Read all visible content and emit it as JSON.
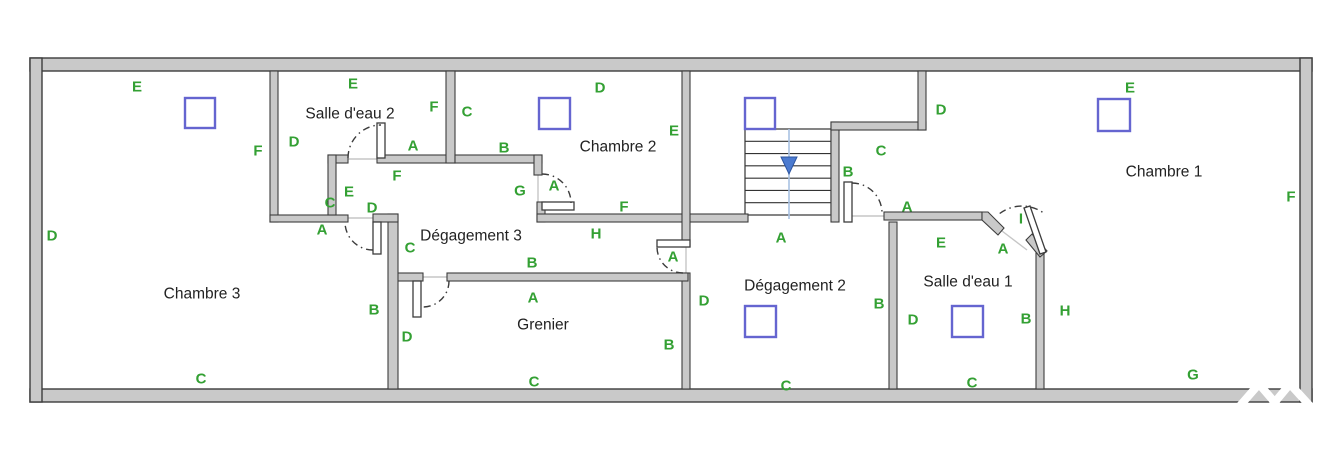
{
  "canvas": {
    "width": 1328,
    "height": 472,
    "background": "#ffffff"
  },
  "colors": {
    "wall_fill": "#c9c9c9",
    "wall_stroke": "#3d3d3d",
    "label_green": "#33a033",
    "room_text": "#222222",
    "skylight_stroke": "#6565d0",
    "stair_line": "#333333",
    "stair_guide": "#a9c2e2",
    "stair_arrow": "#4c7bd0",
    "door_arc": "#3c3c3c",
    "threshold": "#c6c6c6",
    "watermark": "#ffffff"
  },
  "rooms": [
    {
      "name": "Chambre 3",
      "x": 202,
      "y": 294
    },
    {
      "name": "Salle d'eau 2",
      "x": 350,
      "y": 114
    },
    {
      "name": "Chambre 2",
      "x": 618,
      "y": 147
    },
    {
      "name": "Chambre 1",
      "x": 1164,
      "y": 172
    },
    {
      "name": "Dégagement 3",
      "x": 471,
      "y": 236
    },
    {
      "name": "Grenier",
      "x": 543,
      "y": 325
    },
    {
      "name": "Dégagement 2",
      "x": 795,
      "y": 286
    },
    {
      "name": "Salle d'eau 1",
      "x": 968,
      "y": 282
    }
  ],
  "wall_labels": [
    {
      "t": "E",
      "x": 137,
      "y": 87
    },
    {
      "t": "F",
      "x": 258,
      "y": 151
    },
    {
      "t": "D",
      "x": 52,
      "y": 236
    },
    {
      "t": "C",
      "x": 201,
      "y": 379
    },
    {
      "t": "B",
      "x": 374,
      "y": 310
    },
    {
      "t": "A",
      "x": 322,
      "y": 230
    },
    {
      "t": "E",
      "x": 353,
      "y": 84
    },
    {
      "t": "F",
      "x": 434,
      "y": 107
    },
    {
      "t": "D",
      "x": 294,
      "y": 142
    },
    {
      "t": "A",
      "x": 413,
      "y": 146
    },
    {
      "t": "C",
      "x": 330,
      "y": 203
    },
    {
      "t": "E",
      "x": 349,
      "y": 192
    },
    {
      "t": "D",
      "x": 372,
      "y": 208
    },
    {
      "t": "F",
      "x": 397,
      "y": 176
    },
    {
      "t": "G",
      "x": 520,
      "y": 191
    },
    {
      "t": "A",
      "x": 554,
      "y": 186
    },
    {
      "t": "C",
      "x": 467,
      "y": 112
    },
    {
      "t": "B",
      "x": 504,
      "y": 148
    },
    {
      "t": "D",
      "x": 600,
      "y": 88
    },
    {
      "t": "E",
      "x": 674,
      "y": 131
    },
    {
      "t": "F",
      "x": 624,
      "y": 207
    },
    {
      "t": "B",
      "x": 532,
      "y": 263
    },
    {
      "t": "H",
      "x": 596,
      "y": 234
    },
    {
      "t": "C",
      "x": 410,
      "y": 248
    },
    {
      "t": "A",
      "x": 673,
      "y": 257
    },
    {
      "t": "A",
      "x": 781,
      "y": 238
    },
    {
      "t": "D",
      "x": 941,
      "y": 110
    },
    {
      "t": "C",
      "x": 881,
      "y": 151
    },
    {
      "t": "B",
      "x": 848,
      "y": 172
    },
    {
      "t": "A",
      "x": 907,
      "y": 207
    },
    {
      "t": "E",
      "x": 941,
      "y": 243
    },
    {
      "t": "A",
      "x": 1003,
      "y": 249
    },
    {
      "t": "I",
      "x": 1021,
      "y": 219
    },
    {
      "t": "D",
      "x": 913,
      "y": 320
    },
    {
      "t": "C",
      "x": 972,
      "y": 383
    },
    {
      "t": "B",
      "x": 1026,
      "y": 319
    },
    {
      "t": "H",
      "x": 1065,
      "y": 311
    },
    {
      "t": "E",
      "x": 1130,
      "y": 88
    },
    {
      "t": "F",
      "x": 1291,
      "y": 197
    },
    {
      "t": "G",
      "x": 1193,
      "y": 375
    },
    {
      "t": "A",
      "x": 533,
      "y": 298
    },
    {
      "t": "D",
      "x": 407,
      "y": 337
    },
    {
      "t": "B",
      "x": 669,
      "y": 345
    },
    {
      "t": "C",
      "x": 534,
      "y": 382
    },
    {
      "t": "D",
      "x": 704,
      "y": 301
    },
    {
      "t": "B",
      "x": 879,
      "y": 304
    },
    {
      "t": "C",
      "x": 786,
      "y": 386
    }
  ],
  "geometry": {
    "outer_walls": [
      {
        "x": 30,
        "y": 58,
        "w": 1282,
        "h": 13
      },
      {
        "x": 30,
        "y": 389,
        "w": 1282,
        "h": 13
      },
      {
        "x": 30,
        "y": 58,
        "w": 12,
        "h": 344
      },
      {
        "x": 1300,
        "y": 58,
        "w": 12,
        "h": 344
      }
    ],
    "inner_walls": [
      {
        "x": 270,
        "y": 71,
        "w": 8,
        "h": 151
      },
      {
        "x": 270,
        "y": 215,
        "w": 78,
        "h": 7
      },
      {
        "x": 328,
        "y": 155,
        "w": 20,
        "h": 8
      },
      {
        "x": 328,
        "y": 155,
        "w": 8,
        "h": 60
      },
      {
        "x": 377,
        "y": 155,
        "w": 78,
        "h": 8
      },
      {
        "x": 446,
        "y": 71,
        "w": 9,
        "h": 92
      },
      {
        "x": 455,
        "y": 155,
        "w": 87,
        "h": 8
      },
      {
        "x": 534,
        "y": 155,
        "w": 8,
        "h": 20
      },
      {
        "x": 537,
        "y": 202,
        "w": 8,
        "h": 20
      },
      {
        "x": 537,
        "y": 214,
        "w": 211,
        "h": 8
      },
      {
        "x": 682,
        "y": 71,
        "w": 8,
        "h": 176
      },
      {
        "x": 682,
        "y": 273,
        "w": 8,
        "h": 116
      },
      {
        "x": 393,
        "y": 273,
        "w": 30,
        "h": 8
      },
      {
        "x": 447,
        "y": 273,
        "w": 241,
        "h": 8
      },
      {
        "x": 388,
        "y": 214,
        "w": 10,
        "h": 175
      },
      {
        "x": 373,
        "y": 214,
        "w": 25,
        "h": 8
      },
      {
        "x": 889,
        "y": 222,
        "w": 8,
        "h": 167
      },
      {
        "x": 1036,
        "y": 253,
        "w": 8,
        "h": 136
      },
      {
        "x": 884,
        "y": 212,
        "w": 98,
        "h": 8
      },
      {
        "x": 831,
        "y": 122,
        "w": 8,
        "h": 100
      },
      {
        "x": 831,
        "y": 122,
        "w": 95,
        "h": 8
      },
      {
        "x": 918,
        "y": 71,
        "w": 8,
        "h": 59
      }
    ],
    "wall_polygons": [
      {
        "name": "salle-deau-1-diagonal-wall",
        "points": "982,212 988,212 1004,228 998,235 982,220"
      },
      {
        "name": "chambre-1-diagonal-wall",
        "points": "1026,240 1032,234 1047,251 1040,257"
      }
    ],
    "door_leaves": [
      {
        "x": 377,
        "y": 123,
        "w": 8,
        "h": 35
      },
      {
        "x": 373,
        "y": 222,
        "w": 8,
        "h": 32
      },
      {
        "x": 413,
        "y": 281,
        "w": 8,
        "h": 36
      },
      {
        "x": 542,
        "y": 202,
        "w": 32,
        "h": 8
      },
      {
        "x": 657,
        "y": 240,
        "w": 33,
        "h": 7
      },
      {
        "x": 844,
        "y": 182,
        "w": 8,
        "h": 40
      }
    ],
    "door_leaf_polygons": [
      {
        "name": "door-leaf-salle-deau-1",
        "points": "1024,208 1030,206 1046,252 1040,254"
      }
    ],
    "door_arcs": [
      {
        "cx": 381,
        "cy": 158,
        "r": 33,
        "a1": 180,
        "a2": 270
      },
      {
        "cx": 373,
        "cy": 222,
        "r": 28,
        "a1": 90,
        "a2": 180
      },
      {
        "cx": 423,
        "cy": 281,
        "r": 26,
        "a1": 0,
        "a2": 90
      },
      {
        "cx": 542,
        "cy": 203,
        "r": 29,
        "a1": 270,
        "a2": 360
      },
      {
        "cx": 683,
        "cy": 247,
        "r": 26,
        "a1": 90,
        "a2": 180
      },
      {
        "cx": 852,
        "cy": 213,
        "r": 30,
        "a1": 270,
        "a2": 360
      },
      {
        "cx": 1022,
        "cy": 243,
        "r": 37,
        "a1": 233,
        "a2": 307
      }
    ],
    "thresholds": [
      {
        "x1": 348,
        "y1": 159,
        "x2": 377,
        "y2": 159
      },
      {
        "x1": 345,
        "y1": 218,
        "x2": 373,
        "y2": 218
      },
      {
        "x1": 423,
        "y1": 277,
        "x2": 447,
        "y2": 277
      },
      {
        "x1": 538,
        "y1": 175,
        "x2": 538,
        "y2": 202
      },
      {
        "x1": 686,
        "y1": 247,
        "x2": 686,
        "y2": 273
      },
      {
        "x1": 852,
        "y1": 216,
        "x2": 884,
        "y2": 216
      },
      {
        "x1": 1002,
        "y1": 231,
        "x2": 1027,
        "y2": 250
      }
    ],
    "stairs": {
      "x": 745,
      "y": 129,
      "w": 86,
      "h": 86,
      "treads": 7,
      "guide_x": 789,
      "guide_y1": 129,
      "guide_y2": 219,
      "arrow": {
        "points": "781,157 797,157 789,174"
      }
    },
    "skylights": [
      {
        "x": 185,
        "y": 98,
        "w": 30,
        "h": 30
      },
      {
        "x": 539,
        "y": 98,
        "w": 31,
        "h": 31
      },
      {
        "x": 745,
        "y": 98,
        "w": 30,
        "h": 31
      },
      {
        "x": 1098,
        "y": 99,
        "w": 32,
        "h": 32
      },
      {
        "x": 745,
        "y": 306,
        "w": 31,
        "h": 31
      },
      {
        "x": 952,
        "y": 306,
        "w": 31,
        "h": 31
      }
    ],
    "watermark": {
      "stroke_width": 8,
      "paths": [
        "M1238,408 L1259,384 L1277,405",
        "M1270,408 L1290,384 L1310,406"
      ]
    }
  }
}
